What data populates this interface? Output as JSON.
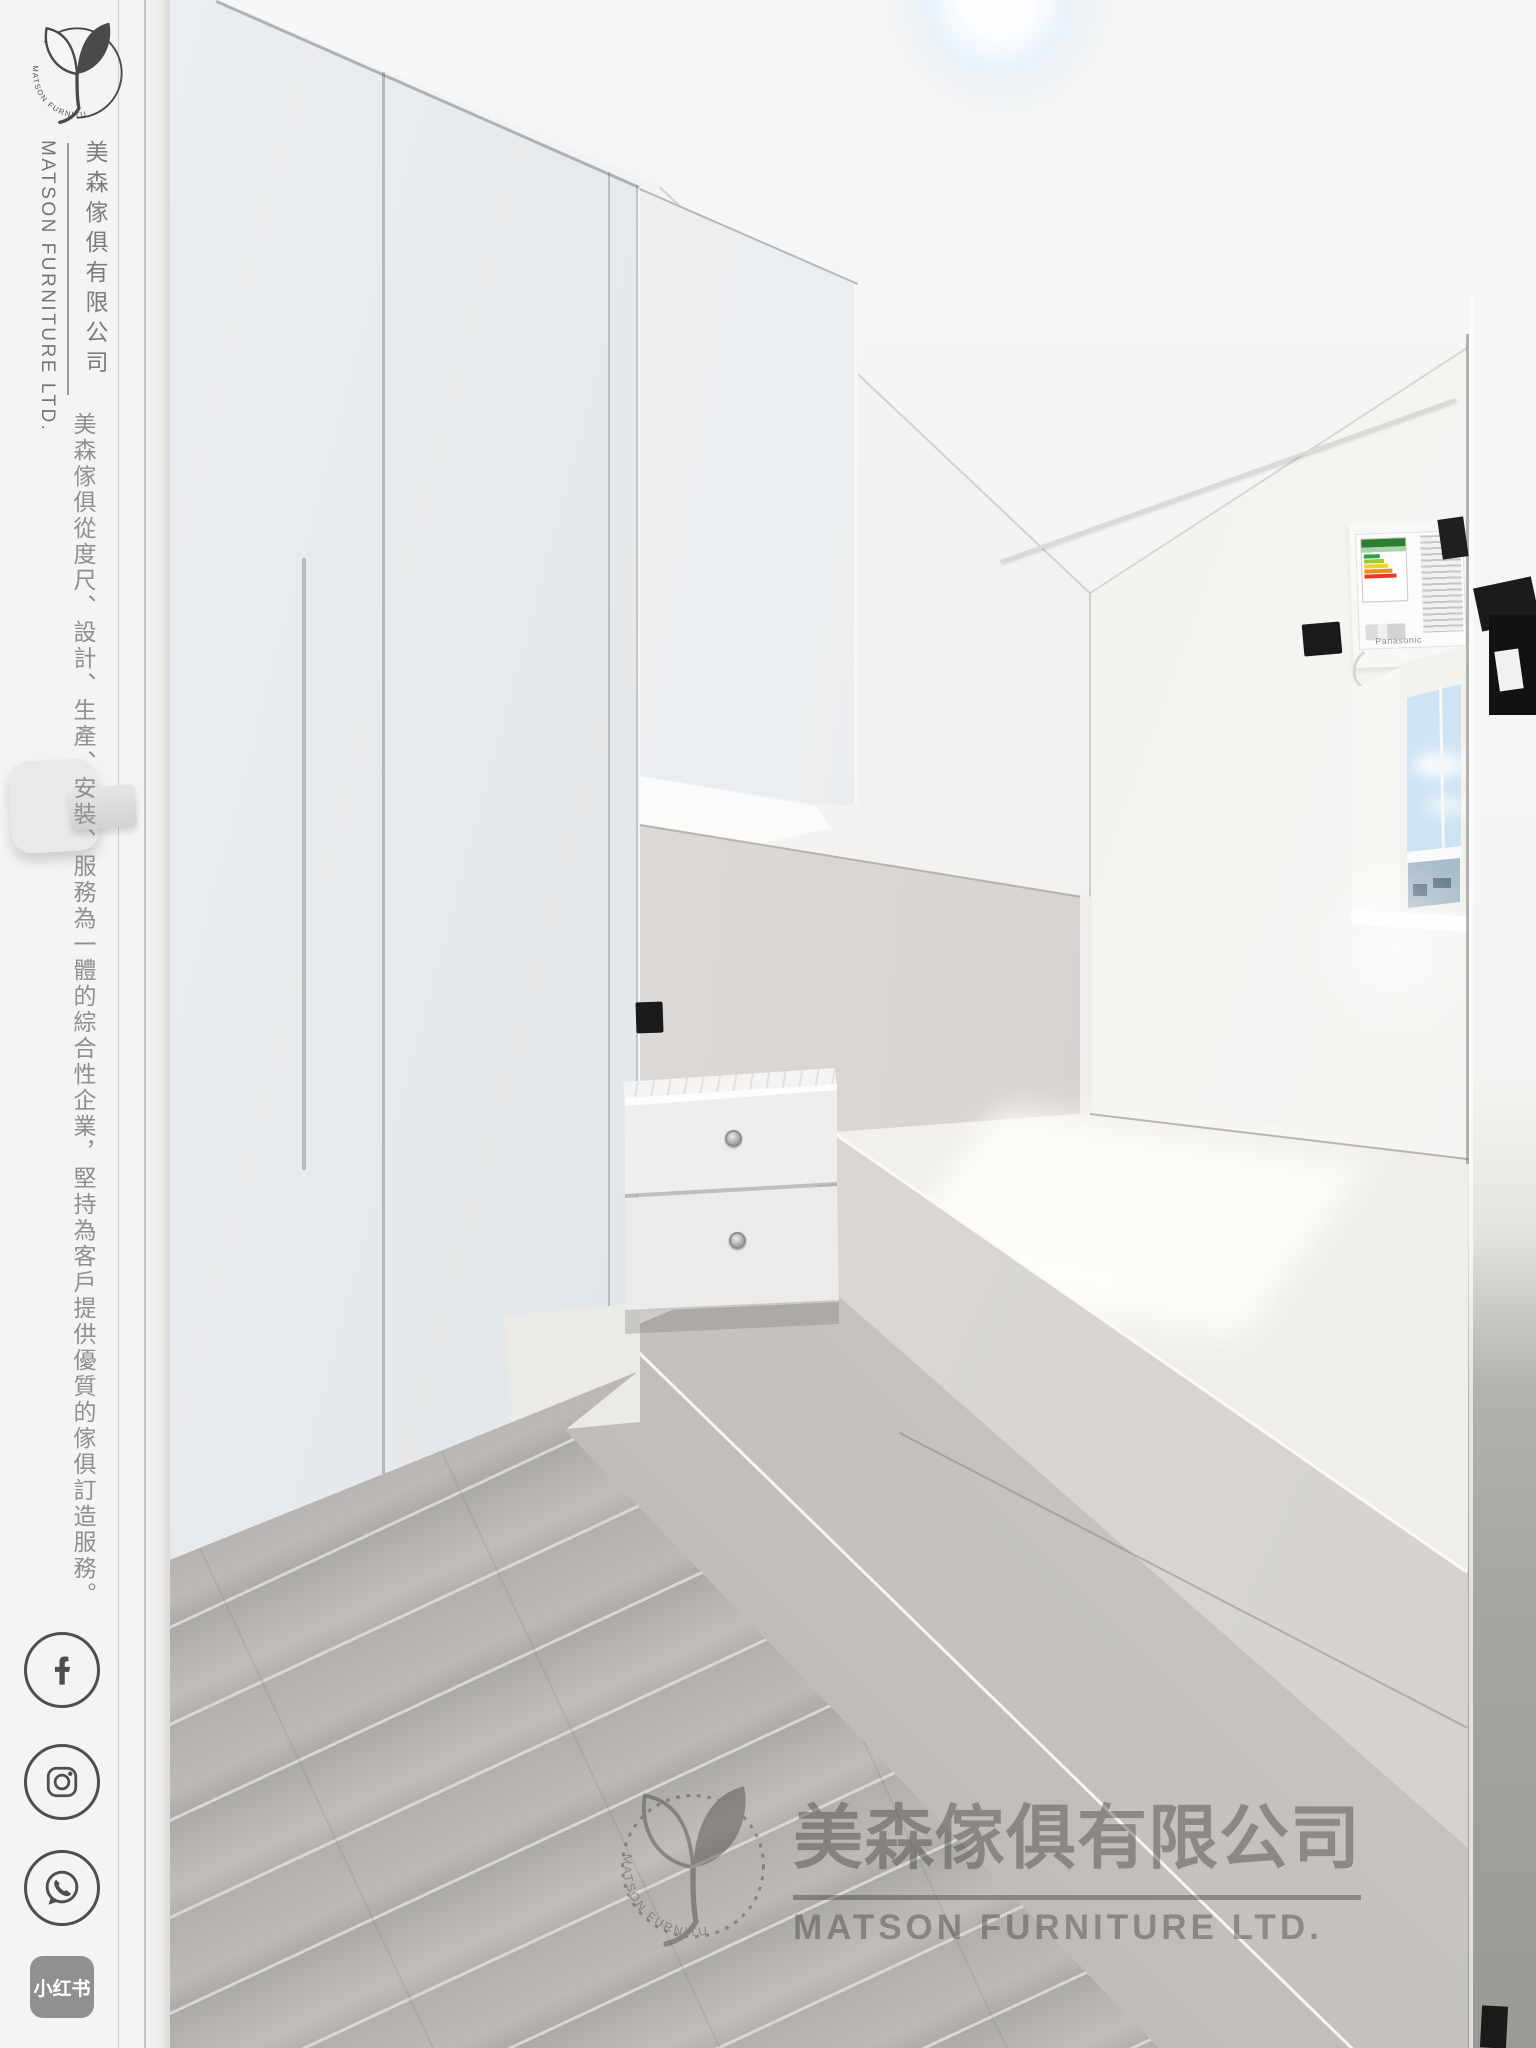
{
  "sidebar": {
    "logo": {
      "ring_text": "MATSON FURNITURE"
    },
    "brand": {
      "name_en": "MATSON FURNITURE LTD.",
      "name_cn": "美森傢俱有限公司"
    },
    "tagline": "美森傢俱從度尺、設計、生產、安裝、服務為一體的綜合性企業，堅持為客戶提供優質的傢俱訂造服務。",
    "social": [
      {
        "name": "Facebook",
        "icon": "facebook-icon"
      },
      {
        "name": "Instagram",
        "icon": "instagram-icon"
      },
      {
        "name": "WhatsApp",
        "icon": "whatsapp-icon"
      },
      {
        "name": "Xiaohongshu",
        "icon": "xiaohongshu-icon",
        "label": "小红书"
      }
    ]
  },
  "photo": {
    "ac_brand": "Panasonic",
    "watermark": {
      "ring_text": "MATSON FURNITURE",
      "name_cn": "美森傢俱有限公司",
      "name_en": "MATSON FURNITURE LTD."
    }
  },
  "colors": {
    "sidebar_bg": "#f4f4f2",
    "sidebar_text": "#8f8f8d",
    "icon_stroke": "#4e4e4c",
    "xiaohongshu_badge": "#90908e",
    "watermark_ink": "#3f3d3a"
  }
}
